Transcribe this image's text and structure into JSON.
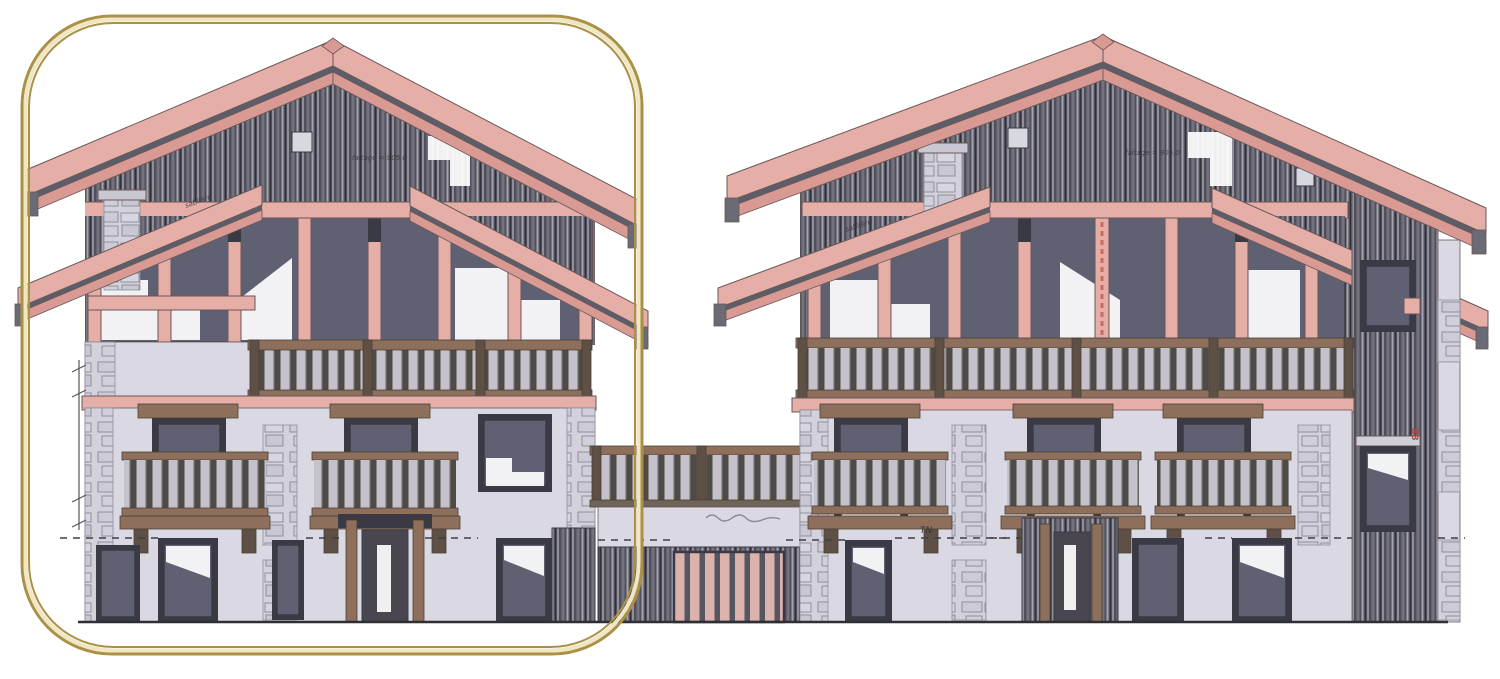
{
  "drawing": {
    "kind": "architectural elevation of two chalets with connecting garage",
    "highlighted_side": "left chalet"
  },
  "annotations": {
    "left_ridge": "faitage = 905.0",
    "right_ridge": "faitage = 905.0",
    "left_eave": "sablière",
    "right_eave": "sablière",
    "ground_label": "TN",
    "red_marker": "88"
  },
  "colors": {
    "paper": "#ffffff",
    "gold": "#ab9048",
    "goldLight": "#efe6c2",
    "pink": "#e5aea6",
    "pinkDark": "#d89a92",
    "edge": "#6b575a",
    "gap": "#5d5d68",
    "clad": "#50505c",
    "streakA": "#8f8e99",
    "streakB": "#73727d",
    "streakC": "#a5a4ae",
    "wall": "#dad9e3",
    "stoneBg": "#d3d2dc",
    "stoneLine": "#8f8f9a",
    "glass": "#5f6173",
    "frame": "#3a3a44",
    "wood": "#8e6f5c",
    "woodDark": "#5f5045",
    "woodEdge": "#4a3f36",
    "railGap": "#c6c2cb",
    "baluster": "#4e4a45",
    "slat": "#dcb2ac",
    "slatGap": "#565662",
    "ink": "#34343b",
    "red": "#b5443c",
    "ground": "#2e2e35"
  }
}
